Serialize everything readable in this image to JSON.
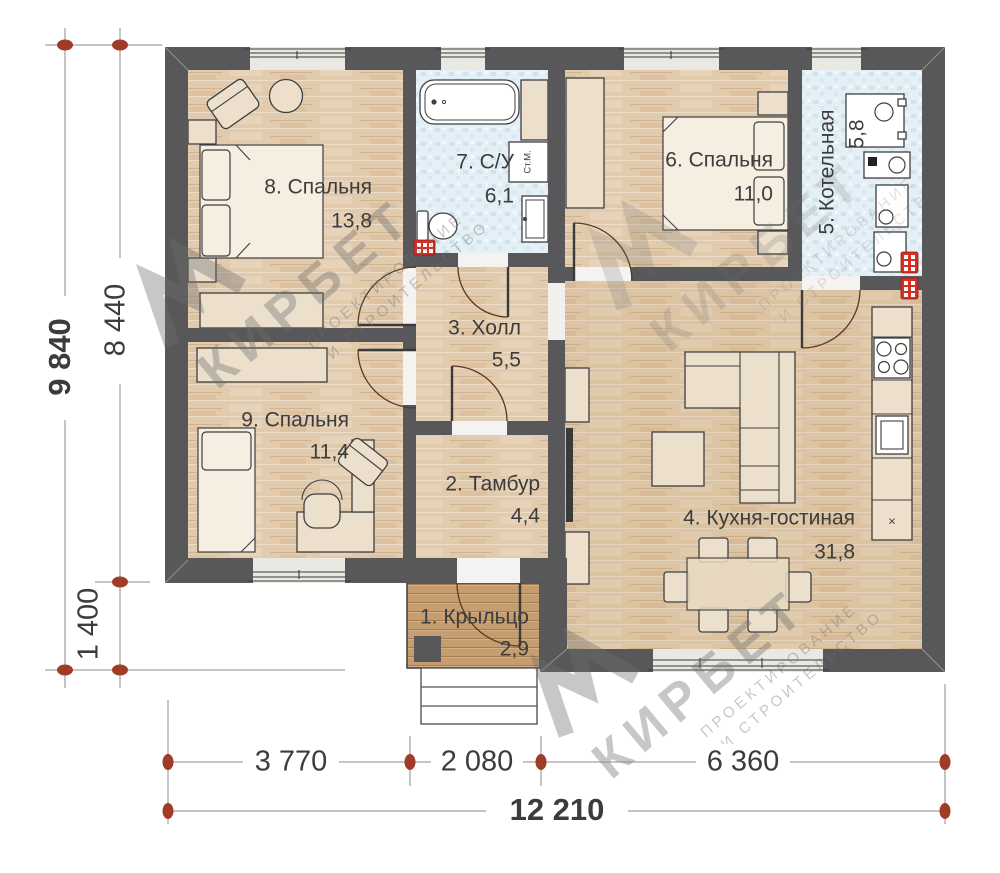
{
  "plan": {
    "rooms": [
      {
        "num": "1",
        "label": "1. Крыльцо",
        "area": "2,9"
      },
      {
        "num": "2",
        "label": "2. Тамбур",
        "area": "4,4"
      },
      {
        "num": "3",
        "label": "3. Холл",
        "area": "5,5"
      },
      {
        "num": "4",
        "label": "4. Кухня-гостиная",
        "area": "31,8"
      },
      {
        "num": "5",
        "label": "5. Котельная",
        "area": "5,8"
      },
      {
        "num": "6",
        "label": "6. Спальня",
        "area": "11,0"
      },
      {
        "num": "7",
        "label": "7. С/У",
        "area": "6,1"
      },
      {
        "num": "8",
        "label": "8. Спальня",
        "area": "13,8"
      },
      {
        "num": "9",
        "label": "9. Спальня",
        "area": "11,4"
      }
    ],
    "appliances": {
      "washing_machine": "Ст.М.",
      "cabinet_mark": "×"
    },
    "dimensions": {
      "bottom_segments": [
        "3 770",
        "2 080",
        "6 360"
      ],
      "bottom_total": "12 210",
      "left_total": "9 840",
      "left_upper": "8 440",
      "left_lower": "1 400"
    },
    "watermark": {
      "brand": "КИРБЕТ",
      "line1": "ПРОЕКТИРОВАНИЕ",
      "line2": "И СТРОИТЕЛЬСТВО"
    },
    "colors": {
      "wall": "#58585a",
      "floor_wood": "#e2cbac",
      "tile": "#e4f0f6",
      "tile_dot": "#c9e2ef",
      "porch": "#c69d6e",
      "porch_line": "#a57c4f",
      "furniture": "#ece0cd",
      "furniture_stroke": "#3f3f3f",
      "window_band": "#eae8e3",
      "radiator": "#d62f24",
      "dim_marker": "#a03b28",
      "dim_line": "#8b8b8b",
      "text": "#3c3c3c",
      "door_arc": "#5a3a20",
      "watermark": "#6e6e6e"
    }
  }
}
